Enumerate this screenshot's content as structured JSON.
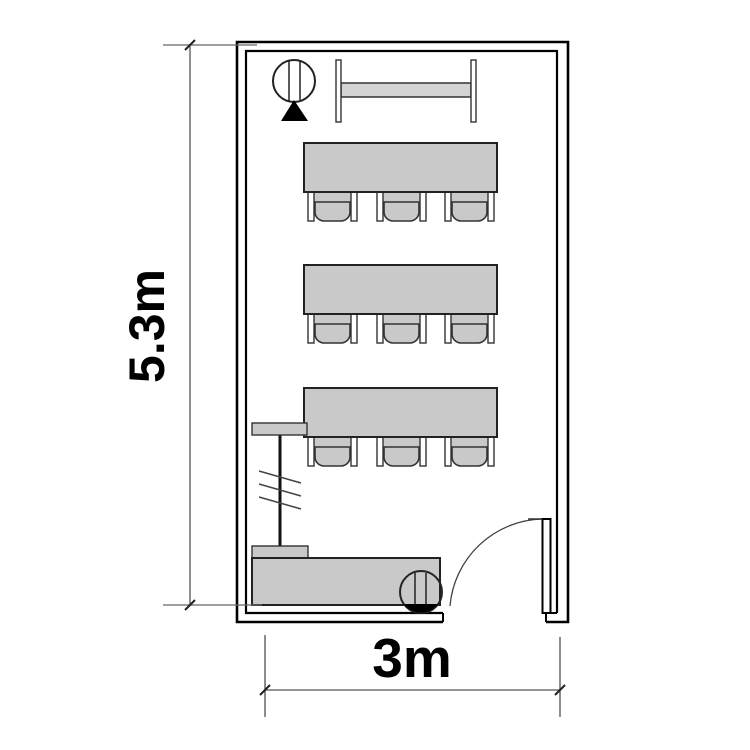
{
  "diagram": {
    "type": "floor-plan",
    "dimensions": {
      "height_label": "5.3m",
      "width_label": "3m"
    },
    "room": {
      "student_table_count": 3,
      "chairs_per_table": 3,
      "items": [
        "round-fixture-with-triangle",
        "trestle-table",
        "student-table-row-1",
        "student-table-row-2",
        "student-table-row-3",
        "projection-screen",
        "teacher-desk",
        "desk-chair",
        "door"
      ]
    },
    "colors": {
      "background": "#ffffff",
      "wall": "#000000",
      "furniture_fill": "#c9c9c9",
      "fixture_bar_fill": "#d4d4d4",
      "outline": "#222222",
      "dimension_line": "#555555",
      "label_text": "#000000",
      "door_arc": "#444444",
      "triangle_fill": "#000000"
    }
  }
}
